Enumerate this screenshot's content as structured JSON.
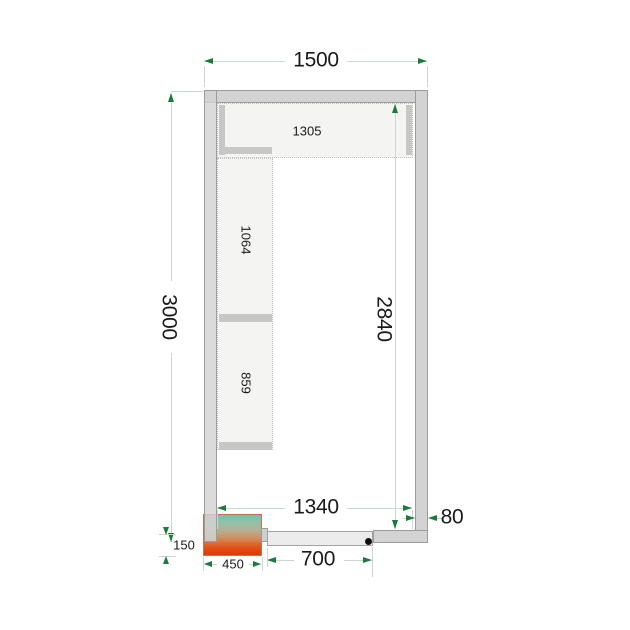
{
  "drawing_labels": {
    "outer_width": "1500",
    "outer_depth": "3000",
    "inner_depth": "2840",
    "inner_width": "1340",
    "wall_thickness": "80",
    "door_width": "700",
    "unit_width": "450",
    "unit_protrusion": "150",
    "shelf_top_length": "1305",
    "shelf_left_upper_length": "1064",
    "shelf_left_lower_length": "859"
  },
  "colors": {
    "dim_line": "#cbd8cf",
    "dim_arrow": "#1e7a39",
    "wall_fill": "#d3d3d3",
    "wall_border": "#9c9c9c",
    "shelf_fill": "#f4f4f2",
    "shelf_edge": "#c7c7c5",
    "unit_cold_end": "#74bfb4",
    "unit_hot_end": "#e23c09",
    "door_pivot": "#111111",
    "label_text": "#1a1a1a"
  }
}
